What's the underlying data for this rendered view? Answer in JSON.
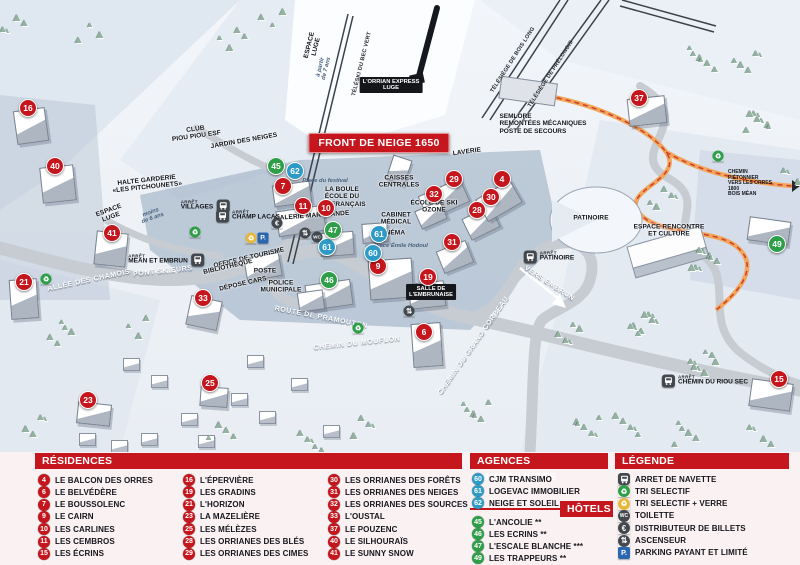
{
  "banner": "FRONT DE NEIGE 1650",
  "arret": "ARRÊT",
  "colors": {
    "residence": "#c5161d",
    "agence": "#2e9ac6",
    "hotel": "#2f9e49",
    "header": "#c5161d",
    "icon_dark": "#43484e",
    "recycle_green": "#2f9e49",
    "recycle_yellow": "#e7b73c",
    "parking_blue": "#2b66b1"
  },
  "map": {
    "markers": [
      {
        "n": "16",
        "type": "residence",
        "x": 28,
        "y": 108
      },
      {
        "n": "40",
        "type": "residence",
        "x": 55,
        "y": 166
      },
      {
        "n": "21",
        "type": "residence",
        "x": 24,
        "y": 282
      },
      {
        "n": "41",
        "type": "residence",
        "x": 112,
        "y": 233
      },
      {
        "n": "33",
        "type": "residence",
        "x": 203,
        "y": 298
      },
      {
        "n": "23",
        "type": "residence",
        "x": 88,
        "y": 400
      },
      {
        "n": "25",
        "type": "residence",
        "x": 210,
        "y": 383
      },
      {
        "n": "7",
        "type": "residence",
        "x": 283,
        "y": 186
      },
      {
        "n": "11",
        "type": "residence",
        "x": 303,
        "y": 206
      },
      {
        "n": "10",
        "type": "residence",
        "x": 326,
        "y": 208
      },
      {
        "n": "9",
        "type": "residence",
        "x": 378,
        "y": 266
      },
      {
        "n": "29",
        "type": "residence",
        "x": 454,
        "y": 179
      },
      {
        "n": "32",
        "type": "residence",
        "x": 434,
        "y": 194
      },
      {
        "n": "4",
        "type": "residence",
        "x": 502,
        "y": 179
      },
      {
        "n": "30",
        "type": "residence",
        "x": 491,
        "y": 197
      },
      {
        "n": "28",
        "type": "residence",
        "x": 477,
        "y": 210
      },
      {
        "n": "31",
        "type": "residence",
        "x": 452,
        "y": 242
      },
      {
        "n": "19",
        "type": "residence",
        "x": 428,
        "y": 277
      },
      {
        "n": "6",
        "type": "residence",
        "x": 424,
        "y": 332
      },
      {
        "n": "37",
        "type": "residence",
        "x": 639,
        "y": 98
      },
      {
        "n": "15",
        "type": "residence",
        "x": 779,
        "y": 379
      },
      {
        "n": "62",
        "type": "agence",
        "x": 295,
        "y": 171
      },
      {
        "n": "61",
        "type": "agence",
        "x": 327,
        "y": 247
      },
      {
        "n": "61",
        "type": "agence",
        "x": 379,
        "y": 234
      },
      {
        "n": "60",
        "type": "agence",
        "x": 373,
        "y": 253
      },
      {
        "n": "45",
        "type": "hotel",
        "x": 276,
        "y": 166
      },
      {
        "n": "47",
        "type": "hotel",
        "x": 333,
        "y": 230
      },
      {
        "n": "46",
        "type": "hotel",
        "x": 329,
        "y": 280
      },
      {
        "n": "49",
        "type": "hotel",
        "x": 777,
        "y": 244
      }
    ],
    "labels": [
      {
        "t": "CLUB\nPIOU PIOU ESF",
        "x": 196,
        "y": 133,
        "c": "fac",
        "r": -8
      },
      {
        "t": "JARDIN DES NEIGES",
        "x": 244,
        "y": 141,
        "c": "fac",
        "r": -10
      },
      {
        "t": "HALTE GARDERIE\n«LES PITCHOUNETS»",
        "x": 147,
        "y": 184,
        "c": "fac",
        "r": -6
      },
      {
        "t": "ESPACE\nLUGE",
        "x": 110,
        "y": 214,
        "c": "fac",
        "r": -20
      },
      {
        "t": "moins\nde 6 ans",
        "x": 152,
        "y": 216,
        "c": "it",
        "r": -20
      },
      {
        "t": "ESPACE\nLUGE",
        "x": 313,
        "y": 46,
        "c": "fac",
        "r": -76
      },
      {
        "t": "à partir\nde 7 ans",
        "x": 324,
        "y": 68,
        "c": "it",
        "r": -76
      },
      {
        "t": "LA BOULE\nÉCOLE DU\nSKI FRANÇAIS",
        "x": 342,
        "y": 197,
        "c": "fac",
        "r": 0
      },
      {
        "t": "Place du festival",
        "x": 325,
        "y": 181,
        "c": "it",
        "r": 0
      },
      {
        "t": "GALERIE MARCHANDE",
        "x": 312,
        "y": 216,
        "c": "fac",
        "r": -4
      },
      {
        "t": "CAISSES\nCENTRALES",
        "x": 399,
        "y": 182,
        "c": "fac",
        "r": 0
      },
      {
        "t": "LAVERIE",
        "x": 467,
        "y": 152,
        "c": "fac",
        "r": -8
      },
      {
        "t": "ÉCOLE DE SKI\nOZONE",
        "x": 434,
        "y": 207,
        "c": "fac",
        "r": 0
      },
      {
        "t": "CABINET\nMÉDICAL",
        "x": 396,
        "y": 219,
        "c": "fac",
        "r": 0
      },
      {
        "t": "CINÉMA",
        "x": 392,
        "y": 233,
        "c": "fac",
        "r": 0
      },
      {
        "t": "Place Émile Hodoul",
        "x": 401,
        "y": 246,
        "c": "it",
        "r": 0
      },
      {
        "t": "OFFICE DE TOURISME",
        "x": 249,
        "y": 258,
        "c": "fac",
        "r": -13
      },
      {
        "t": "BIBLIOTHÈQUE",
        "x": 228,
        "y": 267,
        "c": "fac",
        "r": -13
      },
      {
        "t": "POSTE",
        "x": 265,
        "y": 271,
        "c": "fac",
        "r": 0
      },
      {
        "t": "DÉPOSE CARS",
        "x": 243,
        "y": 284,
        "c": "fac",
        "r": -13
      },
      {
        "t": "POLICE\nMUNICIPALE",
        "x": 281,
        "y": 287,
        "c": "fac",
        "r": 0
      },
      {
        "t": "PATINOIRE",
        "x": 591,
        "y": 218,
        "c": "fac",
        "r": 0
      },
      {
        "t": "ESPACE RENCONTRE\nET CULTURE",
        "x": 669,
        "y": 231,
        "c": "fac",
        "r": 0
      },
      {
        "t": "SEMLORE\nREMONTÉES MÉCANIQUES\nPOSTE DE SECOURS",
        "x": 543,
        "y": 124,
        "c": "fac-l",
        "r": 0
      },
      {
        "t": "CHEMIN PIÉTONNIER\nVERS LES ORRES 1800\nBOIS MÉAN",
        "x": 752,
        "y": 184,
        "c": "tiny",
        "r": 0
      },
      {
        "t": "L'ORRIAN EXPRESS\nLUGE",
        "x": 391,
        "y": 85,
        "c": "chip",
        "r": 0
      },
      {
        "t": "SALLE DE\nL'EMBRUNAISE",
        "x": 431,
        "y": 292,
        "c": "chip",
        "r": 0
      },
      {
        "t": "ALLÉE DES CHAMOIS",
        "x": 89,
        "y": 281,
        "c": "road",
        "r": -12
      },
      {
        "t": "PONT SKIEURS",
        "x": 163,
        "y": 272,
        "c": "road",
        "r": -6
      },
      {
        "t": "ROUTE DE PRAMOUTON",
        "x": 321,
        "y": 318,
        "c": "road",
        "r": 11
      },
      {
        "t": "CHEMIN DU MOUFLON",
        "x": 357,
        "y": 344,
        "c": "road",
        "r": -6
      },
      {
        "t": "CHEMIN DU GRAND CORBEAU",
        "x": 474,
        "y": 346,
        "c": "road",
        "r": -55
      },
      {
        "t": "VERS EMBRUN",
        "x": 549,
        "y": 284,
        "c": "road",
        "r": 33
      },
      {
        "t": "TÉLÉSIÈGE DE BOIS LONG",
        "x": 513,
        "y": 60,
        "c": "lift",
        "r": -57
      },
      {
        "t": "TÉLÉSIÈGE DE PRÉLONGIS",
        "x": 551,
        "y": 74,
        "c": "lift",
        "r": -57
      },
      {
        "t": "TÉLÉSKI DU BEC VERT",
        "x": 362,
        "y": 64,
        "c": "lift",
        "r": -76
      }
    ],
    "bus_stops": [
      {
        "stop": "VILLAGES",
        "x": 205,
        "y": 206,
        "icon": "right"
      },
      {
        "stop": "CHAMP LACAS",
        "x": 248,
        "y": 216,
        "icon": "left"
      },
      {
        "stop": "MÉAN ET EMBRUN",
        "x": 166,
        "y": 260,
        "icon": "right"
      },
      {
        "stop": "PATINOIRE",
        "x": 549,
        "y": 257,
        "icon": "left"
      },
      {
        "stop": "CHEMIN DU RIOU SEC",
        "x": 705,
        "y": 381,
        "icon": "left"
      }
    ],
    "poi_icons": [
      {
        "type": "parking",
        "x": 263,
        "y": 238
      },
      {
        "type": "recycle-yellow",
        "x": 251,
        "y": 238
      },
      {
        "type": "euro",
        "x": 277,
        "y": 223
      },
      {
        "type": "wc",
        "x": 317,
        "y": 237
      },
      {
        "type": "elevator",
        "x": 305,
        "y": 233
      },
      {
        "type": "elevator",
        "x": 409,
        "y": 311
      },
      {
        "type": "recycle-green",
        "x": 195,
        "y": 232
      },
      {
        "type": "recycle-green",
        "x": 46,
        "y": 279
      },
      {
        "type": "recycle-green",
        "x": 358,
        "y": 328
      },
      {
        "type": "recycle-green",
        "x": 718,
        "y": 156
      }
    ]
  },
  "legend": {
    "residences": {
      "title": "RÉSIDENCES",
      "columns": [
        [
          {
            "n": "4",
            "name": "LE BALCON DES ORRES"
          },
          {
            "n": "6",
            "name": "LE BELVÉDÈRE"
          },
          {
            "n": "7",
            "name": "LE BOUSSOLENC"
          },
          {
            "n": "9",
            "name": "LE CAIRN"
          },
          {
            "n": "10",
            "name": "LES CARLINES"
          },
          {
            "n": "11",
            "name": "LES CEMBROS"
          },
          {
            "n": "15",
            "name": "LES ÉCRINS"
          }
        ],
        [
          {
            "n": "16",
            "name": "L'ÉPERVIÈRE"
          },
          {
            "n": "19",
            "name": "LES GRADINS"
          },
          {
            "n": "21",
            "name": "L'HORIZON"
          },
          {
            "n": "23",
            "name": "LA MAZELIÈRE"
          },
          {
            "n": "25",
            "name": "LES MÉLÈZES"
          },
          {
            "n": "28",
            "name": "LES ORRIANES DES BLÉS"
          },
          {
            "n": "29",
            "name": "LES ORRIANES DES CIMES"
          }
        ],
        [
          {
            "n": "30",
            "name": "LES ORRIANES DES FORÊTS"
          },
          {
            "n": "31",
            "name": "LES ORRIANES DES NEIGES"
          },
          {
            "n": "32",
            "name": "LES ORRIANES DES SOURCES"
          },
          {
            "n": "33",
            "name": "L'OUSTAL"
          },
          {
            "n": "37",
            "name": "LE POUZENC"
          },
          {
            "n": "40",
            "name": "LE SILHOURAÏS"
          },
          {
            "n": "41",
            "name": "LE SUNNY SNOW"
          }
        ]
      ]
    },
    "agences": {
      "title": "AGENCES IMMOBILIÈRES",
      "items": [
        {
          "n": "60",
          "name": "CJM TRANSIMO"
        },
        {
          "n": "61",
          "name": "LOGEVAC IMMOBILIER"
        },
        {
          "n": "62",
          "name": "NEIGE ET SOLEIL"
        }
      ]
    },
    "hotels": {
      "title": "HÔTELS",
      "items": [
        {
          "n": "45",
          "name": "L'ANCOLIE **"
        },
        {
          "n": "46",
          "name": "LES ECRINS **"
        },
        {
          "n": "47",
          "name": "L'ESCALE BLANCHE ***"
        },
        {
          "n": "49",
          "name": "LES TRAPPEURS **"
        }
      ]
    },
    "legende": {
      "title": "LÉGENDE",
      "items": [
        {
          "icon": "bus",
          "label": "ARRET DE NAVETTE"
        },
        {
          "icon": "recycle-green",
          "label": "TRI SELECTIF"
        },
        {
          "icon": "recycle-yellow",
          "label": "TRI SELECTIF + VERRE"
        },
        {
          "icon": "wc",
          "label": "TOILETTE"
        },
        {
          "icon": "euro",
          "label": "DISTRIBUTEUR DE BILLETS"
        },
        {
          "icon": "elevator",
          "label": "ASCENSEUR"
        },
        {
          "icon": "parking",
          "label": "PARKING PAYANT ET LIMITÉ"
        }
      ]
    }
  }
}
